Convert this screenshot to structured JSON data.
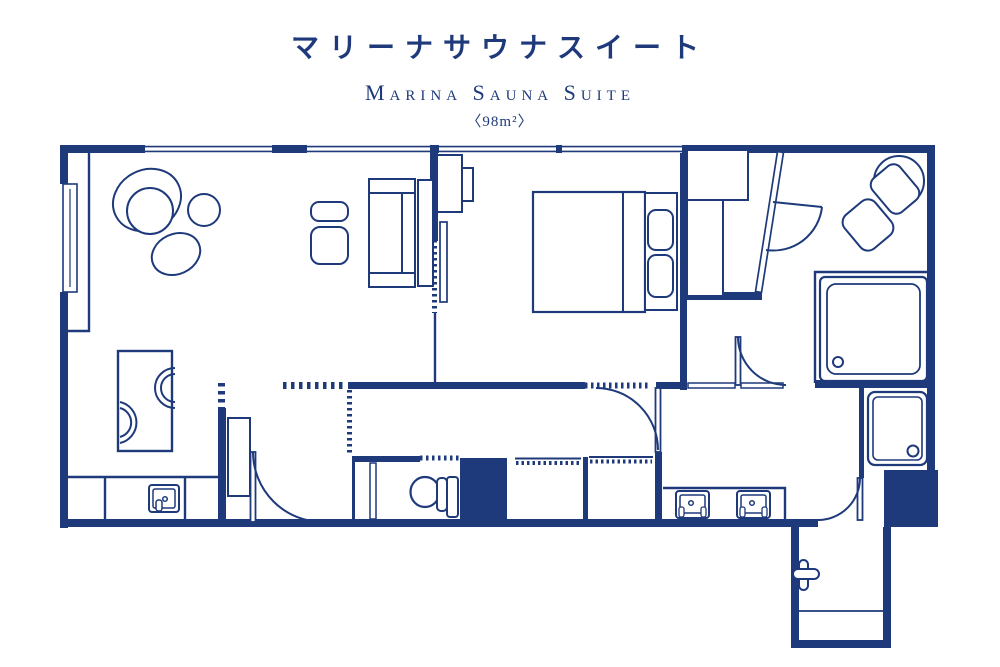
{
  "header": {
    "title_ja": "マリーナサウナスイート",
    "title_en": "Marina Sauna Suite",
    "area": "〈98m²〉"
  },
  "colors": {
    "ink": "#1e3a7b",
    "background": "#ffffff"
  }
}
